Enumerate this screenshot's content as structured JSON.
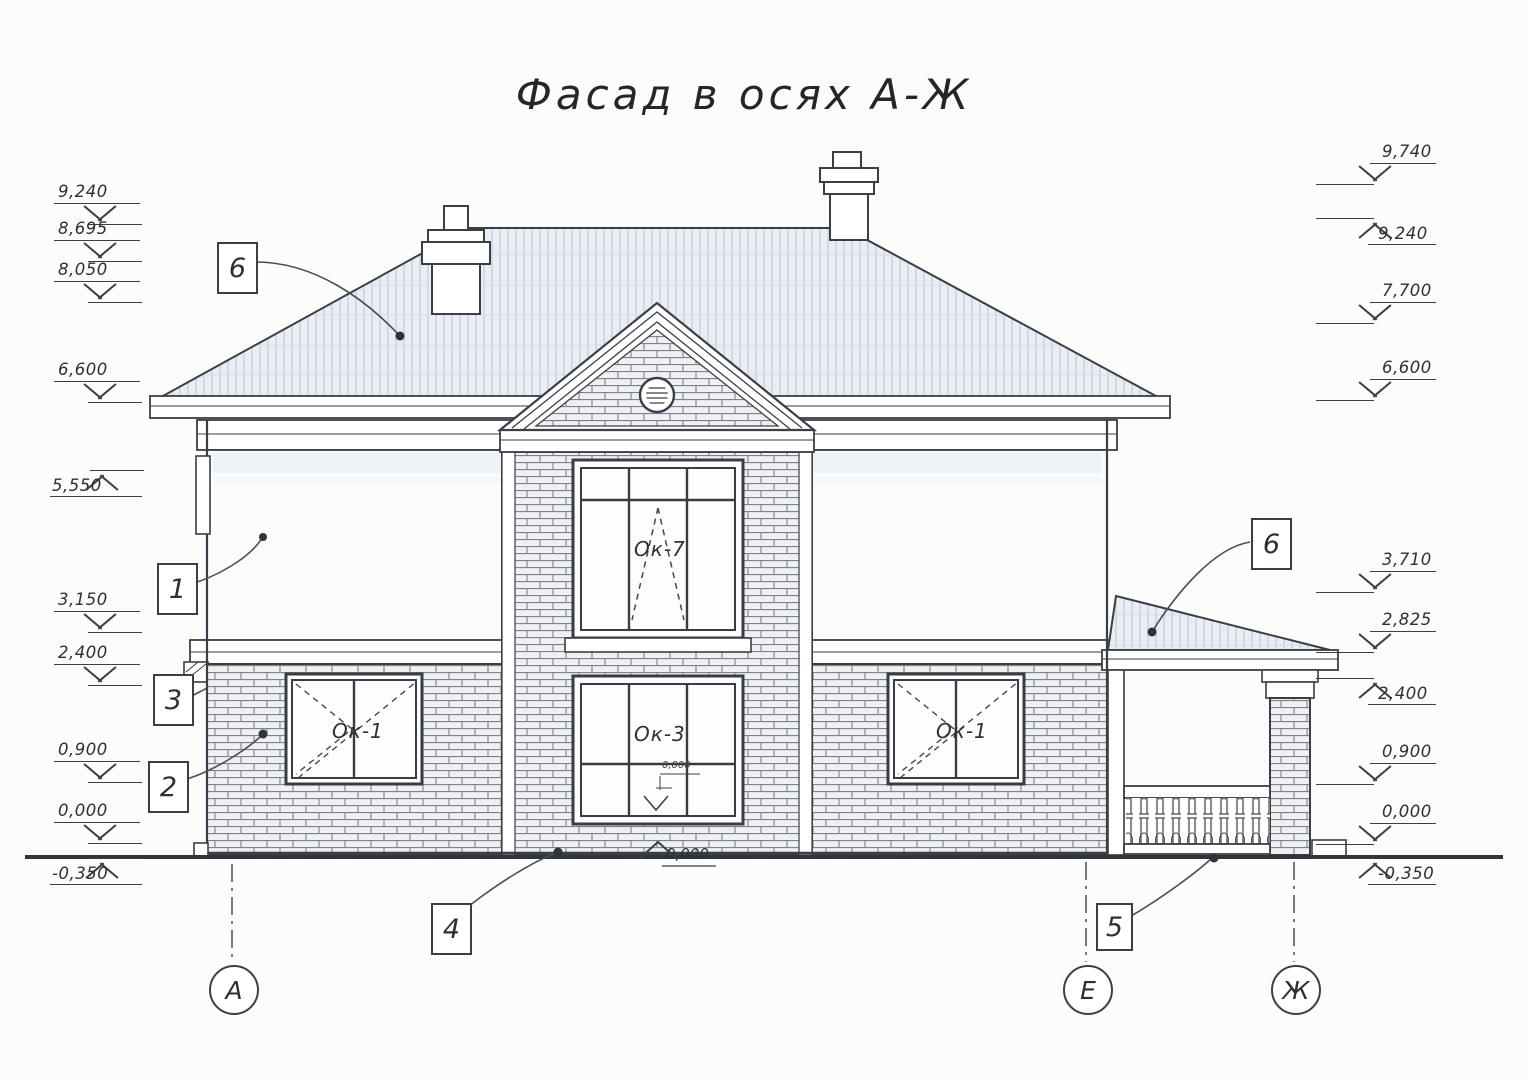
{
  "title": "Фасад в осях А-Ж",
  "elevations": {
    "left": [
      {
        "value": "9,240"
      },
      {
        "value": "8,695"
      },
      {
        "value": "8,050"
      },
      {
        "value": "6,600"
      },
      {
        "value": "5,550"
      },
      {
        "value": "3,150"
      },
      {
        "value": "2,400"
      },
      {
        "value": "0,900"
      },
      {
        "value": "0,000"
      },
      {
        "value": "-0,350"
      }
    ],
    "right": [
      {
        "value": "9,740"
      },
      {
        "value": "9,240"
      },
      {
        "value": "7,700"
      },
      {
        "value": "6,600"
      },
      {
        "value": "3,710"
      },
      {
        "value": "2,825"
      },
      {
        "value": "2,400"
      },
      {
        "value": "0,900"
      },
      {
        "value": "0,000"
      },
      {
        "value": "-0,350"
      }
    ]
  },
  "callouts": {
    "roof_left": "6",
    "wall_upper": "1",
    "belt": "3",
    "wall_lower": "2",
    "porch_roof": "6",
    "base": "4",
    "porch": "5"
  },
  "axes": {
    "a": "А",
    "e": "Е",
    "zh": "Ж"
  },
  "window_labels": {
    "left": "Ок-1",
    "center_upper": "Ок-7",
    "center_lower": "Ок-3",
    "right": "Ок-1"
  },
  "level_marks": {
    "sill": "0,000",
    "base_center": "0,000"
  },
  "colors": {
    "line": "#3a3f46",
    "brick_line": "#7d838c",
    "roof_fill": "#e9eef4",
    "roof_hatch": "#b6c4d3",
    "paper": "#fcfcfa"
  }
}
